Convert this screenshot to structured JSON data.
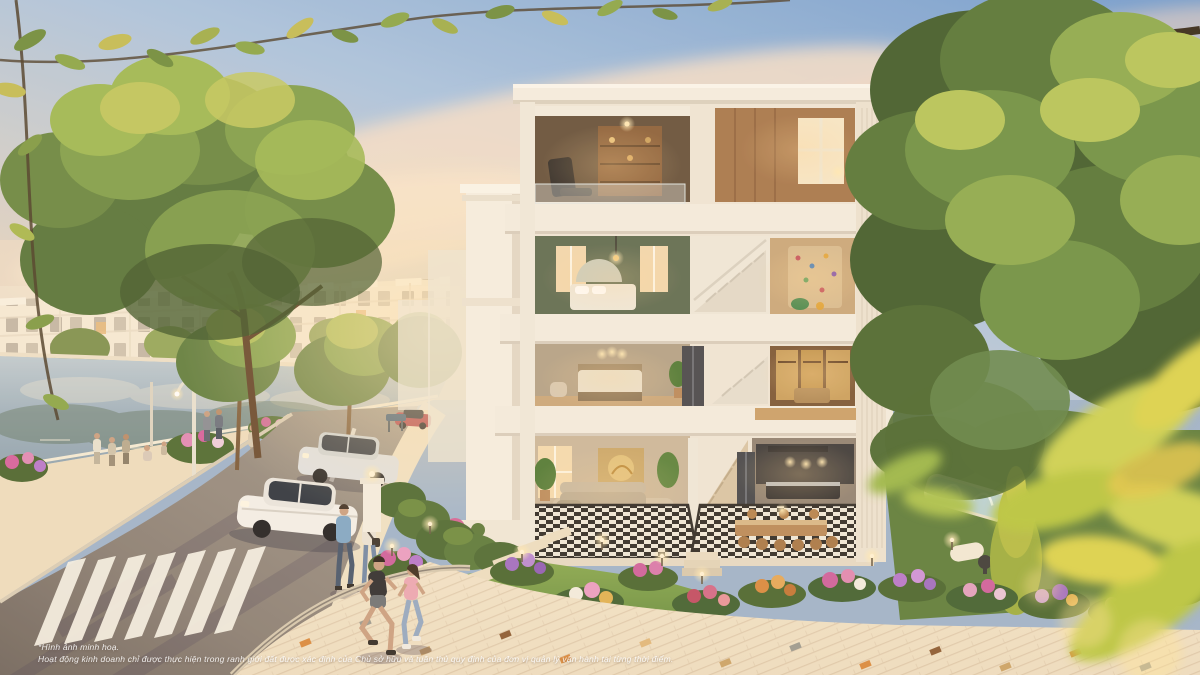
{
  "disclaimer": {
    "line1": "*Hình ảnh minh hoạ.",
    "line2": "Hoạt động kinh doanh chỉ được thực hiện trong ranh giới đất được xác định của Chủ sở hữu và tuân thủ quy định của đơn vị quản lý vận hành tại từng thời điểm."
  },
  "palette": {
    "sky_top": "#6d9bd3",
    "sky_mid": "#aac5e3",
    "sky_horizon": "#eedcc6",
    "cloud_pink": "#f5dcc8",
    "villa_white": "#f3eee3",
    "interior_amber": "#d9a360",
    "foliage_green": "#5e7c3e",
    "foliage_highlight": "#c6cf5e",
    "road_gray": "#837970",
    "water_blue": "#a4b7c5",
    "lawn_green": "#6f9747",
    "flower_magenta": "#cf5f9f",
    "flower_purple": "#a06cc4",
    "plaza_cream": "#efe2c9",
    "townhouse_cream": "#f3e9d6"
  }
}
